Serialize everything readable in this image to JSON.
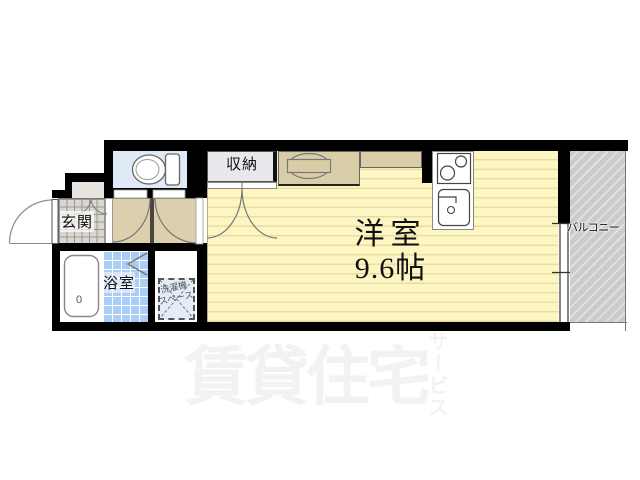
{
  "plan": {
    "labels": {
      "main_room": "洋室",
      "main_room_size": "9.6帖",
      "closet": "収納",
      "entrance": "玄関",
      "bathroom": "浴室",
      "balcony": "バルコニー",
      "washing_machine_line1": "洗濯機",
      "washing_machine_line2": "スペース",
      "tub_drain": "0"
    },
    "watermark": {
      "main": "賃貸住宅",
      "vertical": "サービス"
    },
    "colors": {
      "wall": "#000000",
      "room_fill": "#fdf6c3",
      "room_stripe": "#e9dda6",
      "hallway_fill": "#dccfae",
      "closet_fill": "#eae8ed",
      "toilet_fill": "#dfeaf6",
      "bath_fill": "#a9cdf4",
      "entrance_fill": "#dad7d2",
      "counter_fill": "#d9cda8",
      "balcony_fill": "#cbcbcb",
      "washing_space_fill": "#e3edf8",
      "watermark": "#f3f2f0"
    }
  }
}
